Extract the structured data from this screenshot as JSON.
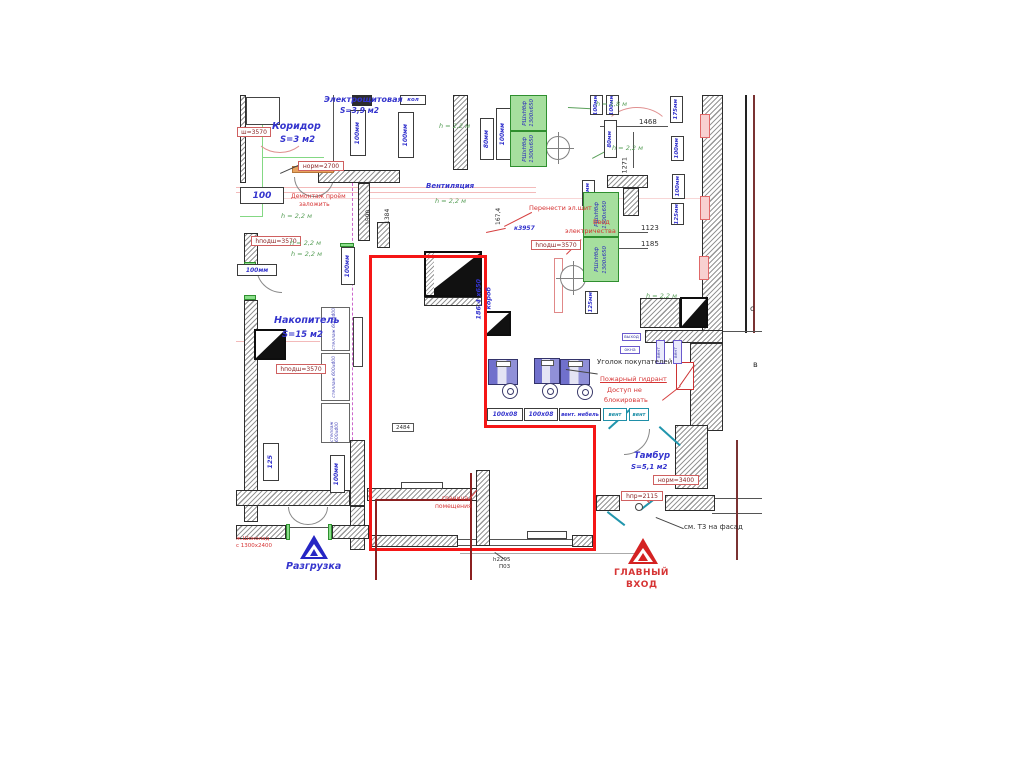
{
  "colors": {
    "premises_boundary": "#f51616",
    "handwritten_blue": "#3434cd",
    "note_red": "#d63434",
    "height_green": "#5aa05a",
    "equipment_green_fill": "#a6df9e"
  },
  "annotations": [
    {
      "n": "room-electro",
      "t": "Электрощитовая",
      "x": 88,
      "y": 1,
      "c": "blu",
      "fs": 8
    },
    {
      "n": "room-electro-area",
      "t": "S=3,9 м2",
      "x": 104,
      "y": 12,
      "c": "blu",
      "fs": 7.5
    },
    {
      "n": "room-corridor",
      "t": "Коридор",
      "x": 36,
      "y": 27,
      "c": "blu",
      "fs": 9.5
    },
    {
      "n": "room-corridor-area",
      "t": "S=3 м2",
      "x": 44,
      "y": 41,
      "c": "blu",
      "fs": 8.5
    },
    {
      "n": "vent-note",
      "t": "Вентиляция",
      "x": 190,
      "y": 88,
      "c": "blu",
      "fs": 7
    },
    {
      "n": "room-nakopitel",
      "t": "Накопитель",
      "x": 38,
      "y": 221,
      "c": "blu",
      "fs": 9.5
    },
    {
      "n": "room-nakopitel-area",
      "t": "S=15 м2",
      "x": 46,
      "y": 236,
      "c": "blu",
      "fs": 8.5
    },
    {
      "n": "room-tambur",
      "t": "Тамбур",
      "x": 398,
      "y": 357,
      "c": "blu",
      "fs": 8.5
    },
    {
      "n": "room-tambur-area",
      "t": "S=5,1 м2",
      "x": 395,
      "y": 369,
      "c": "blu",
      "fs": 7
    },
    {
      "n": "unloading-label",
      "t": "Разгрузка",
      "x": 50,
      "y": 467,
      "c": "blu",
      "fs": 9.5
    },
    {
      "n": "ref-k3957",
      "t": "к3957",
      "x": 278,
      "y": 131,
      "c": "blu",
      "fs": 6
    },
    {
      "n": "duct-size",
      "t": "186,4 х650",
      "x": 246,
      "y": 218,
      "c": "blu",
      "fs": 6.5,
      "r": -90
    },
    {
      "n": "duct-size2",
      "t": "короб",
      "x": 256,
      "y": 208,
      "c": "blu",
      "fs": 6.5,
      "r": -90
    },
    {
      "n": "note-demontazh",
      "t": "Демонтаж проём",
      "x": 55,
      "y": 99,
      "c": "red",
      "fs": 6
    },
    {
      "n": "note-demontazh2",
      "t": "заложить",
      "x": 63,
      "y": 107,
      "c": "red",
      "fs": 6
    },
    {
      "n": "note-perenesti",
      "t": "Перенести эл.щит",
      "x": 293,
      "y": 110,
      "c": "red",
      "fs": 6.5
    },
    {
      "n": "note-vvod",
      "t": "Ввод",
      "x": 357,
      "y": 124,
      "c": "red",
      "fs": 6.5
    },
    {
      "n": "note-vvod2",
      "t": "электричества",
      "x": 329,
      "y": 133,
      "c": "red",
      "fs": 6.5
    },
    {
      "n": "corner-label",
      "t": "Уголок покупателей",
      "x": 361,
      "y": 264,
      "c": "dim",
      "fs": 7
    },
    {
      "n": "hydrant-note",
      "t": "Пожарный гидрант",
      "x": 364,
      "y": 281,
      "c": "red u",
      "fs": 6.5
    },
    {
      "n": "hydrant-note2",
      "t": "Доступ не",
      "x": 371,
      "y": 292,
      "c": "red",
      "fs": 6.5
    },
    {
      "n": "hydrant-note3",
      "t": "блокировать",
      "x": 368,
      "y": 302,
      "c": "red",
      "fs": 6.5
    },
    {
      "n": "boundary-note",
      "t": "граница",
      "x": 206,
      "y": 401,
      "c": "red",
      "fs": 6
    },
    {
      "n": "boundary-note2",
      "t": "помещения",
      "x": 199,
      "y": 409,
      "c": "red",
      "fs": 6
    },
    {
      "n": "main-entrance-label",
      "t": "ГЛАВНЫЙ",
      "x": 378,
      "y": 474,
      "c": "red cap",
      "fs": 9
    },
    {
      "n": "main-entrance-label2",
      "t": "ВХОД",
      "x": 390,
      "y": 486,
      "c": "red cap",
      "fs": 9
    },
    {
      "n": "chocolate-note",
      "t": "ж.Шоколад",
      "x": 0,
      "y": 442,
      "c": "red",
      "fs": 5.5
    },
    {
      "n": "chocolate-note2",
      "t": "с 1300х2400",
      "x": 0,
      "y": 449,
      "c": "red",
      "fs": 5.5
    },
    {
      "n": "h22-1",
      "t": "h = 2,2 м",
      "x": 45,
      "y": 118,
      "c": "grn",
      "fs": 6.5
    },
    {
      "n": "h22-2",
      "t": "h = 2,2 м",
      "x": 54,
      "y": 145,
      "c": "grn",
      "fs": 6.5
    },
    {
      "n": "h22-3",
      "t": "h = 2,2 м",
      "x": 55,
      "y": 156,
      "c": "grn",
      "fs": 6.5
    },
    {
      "n": "h22-4",
      "t": "h = 2,2 м",
      "x": 203,
      "y": 28,
      "c": "grn",
      "fs": 6.5
    },
    {
      "n": "h22-5",
      "t": "h = 2,2 м",
      "x": 199,
      "y": 103,
      "c": "grn",
      "fs": 6.5
    },
    {
      "n": "h22-6",
      "t": "h = 2,2 м",
      "x": 376,
      "y": 50,
      "c": "grn",
      "fs": 6.5
    },
    {
      "n": "h22-7",
      "t": "h = 2,2 м",
      "x": 410,
      "y": 198,
      "c": "grn",
      "fs": 6.5
    },
    {
      "n": "h18",
      "t": "h = 1,8 м",
      "x": 360,
      "y": 6,
      "c": "grn",
      "fs": 6.5
    },
    {
      "n": "dim-1468",
      "t": "1468",
      "x": 403,
      "y": 24,
      "c": "dim",
      "fs": 7
    },
    {
      "n": "dim-1271",
      "t": "1271",
      "x": 392,
      "y": 72,
      "c": "dim",
      "fs": 6.5,
      "r": -90
    },
    {
      "n": "dim-1123",
      "t": "1123",
      "x": 405,
      "y": 130,
      "c": "dim",
      "fs": 7
    },
    {
      "n": "dim-1185",
      "t": "1185",
      "x": 405,
      "y": 146,
      "c": "dim",
      "fs": 7
    },
    {
      "n": "dim-167-4",
      "t": "167,4",
      "x": 266,
      "y": 124,
      "c": "dim",
      "fs": 6,
      "r": -90
    },
    {
      "n": "dim-1590",
      "t": "1590",
      "x": 136,
      "y": 124,
      "c": "dim",
      "fs": 6,
      "r": -90
    },
    {
      "n": "dim-1384",
      "t": "1384",
      "x": 155,
      "y": 123,
      "c": "dim",
      "fs": 6,
      "r": -90
    },
    {
      "n": "dim-h2295",
      "t": "h2295",
      "x": 257,
      "y": 463,
      "c": "dim",
      "fs": 5.5
    },
    {
      "n": "dim-p03",
      "t": "П03",
      "x": 263,
      "y": 470,
      "c": "dim",
      "fs": 5.5
    },
    {
      "n": "facade-note",
      "t": "см. Т3 на фасад",
      "x": 448,
      "y": 429,
      "c": "dim",
      "fs": 7
    },
    {
      "n": "letter-c",
      "t": "с",
      "x": 514,
      "y": 210,
      "c": "dim",
      "fs": 8
    },
    {
      "n": "letter-v",
      "t": "в",
      "x": 517,
      "y": 266,
      "c": "dim",
      "fs": 8
    }
  ],
  "boxes": [
    {
      "n": "pipe-100-a",
      "t": "100",
      "x": 4,
      "y": 92,
      "w": 44,
      "h": 17,
      "c": "pipe",
      "fs": 9
    },
    {
      "n": "pipe-100-b",
      "t": "100мм",
      "x": 1,
      "y": 169,
      "w": 40,
      "h": 12,
      "c": "pipe",
      "fs": 6
    },
    {
      "n": "pipe-kol",
      "t": "кол",
      "x": 164,
      "y": 0,
      "w": 26,
      "h": 10,
      "c": "pipe",
      "fs": 5.5
    },
    {
      "n": "pipe-100-1",
      "t": "100мм",
      "x": 114,
      "y": 15,
      "w": 16,
      "h": 46,
      "c": "pipev",
      "fs": 6
    },
    {
      "n": "pipe-100-2",
      "t": "100мм",
      "x": 162,
      "y": 17,
      "w": 16,
      "h": 46,
      "c": "pipev",
      "fs": 6
    },
    {
      "n": "pipe-80-1",
      "t": "80мм",
      "x": 244,
      "y": 23,
      "w": 14,
      "h": 42,
      "c": "pipev",
      "fs": 6
    },
    {
      "n": "pipe-100-3",
      "t": "100мм",
      "x": 260,
      "y": 13,
      "w": 15,
      "h": 52,
      "c": "pipev",
      "fs": 6
    },
    {
      "n": "pipe-100-4",
      "t": "100мм",
      "x": 105,
      "y": 152,
      "w": 14,
      "h": 38,
      "c": "pipev",
      "fs": 6
    },
    {
      "n": "pipe-100-5",
      "t": "100мм",
      "x": 94,
      "y": 360,
      "w": 15,
      "h": 38,
      "c": "pipev",
      "fs": 6
    },
    {
      "n": "pipe-125-1",
      "t": "125",
      "x": 27,
      "y": 348,
      "w": 16,
      "h": 38,
      "c": "pipev",
      "fs": 6.5
    },
    {
      "n": "pipe-175",
      "t": "175мм",
      "x": 434,
      "y": 1,
      "w": 13,
      "h": 27,
      "c": "pipev",
      "fs": 5.5
    },
    {
      "n": "pipe-100-6",
      "t": "100мм",
      "x": 435,
      "y": 41,
      "w": 13,
      "h": 25,
      "c": "pipev",
      "fs": 5.5
    },
    {
      "n": "pipe-100-7",
      "t": "100мм",
      "x": 436,
      "y": 79,
      "w": 13,
      "h": 25,
      "c": "pipev",
      "fs": 5.5
    },
    {
      "n": "pipe-125-2",
      "t": "125мм",
      "x": 435,
      "y": 108,
      "w": 13,
      "h": 22,
      "c": "pipev",
      "fs": 5.5
    },
    {
      "n": "pipe-100-8",
      "t": "100мм",
      "x": 346,
      "y": 85,
      "w": 13,
      "h": 26,
      "c": "pipev",
      "fs": 5.5
    },
    {
      "n": "pipe-125-3",
      "t": "125мм",
      "x": 347,
      "y": 160,
      "w": 13,
      "h": 26,
      "c": "pipev",
      "fs": 5.5
    },
    {
      "n": "pipe-125-4",
      "t": "125мм",
      "x": 349,
      "y": 196,
      "w": 13,
      "h": 23,
      "c": "pipev",
      "fs": 5.5
    },
    {
      "n": "pipe-80-2",
      "t": "80мм",
      "x": 368,
      "y": 25,
      "w": 13,
      "h": 38,
      "c": "pipev",
      "fs": 5.5
    },
    {
      "n": "pipe-100-9",
      "t": "100мм",
      "x": 354,
      "y": 0,
      "w": 13,
      "h": 20,
      "c": "pipev",
      "fs": 5.5
    },
    {
      "n": "pipe-100-10",
      "t": "100мм",
      "x": 370,
      "y": 0,
      "w": 13,
      "h": 20,
      "c": "pipev",
      "fs": 5.5
    },
    {
      "n": "pipe-100-11",
      "t": "100мм",
      "x": 287,
      "y": 0,
      "w": 13,
      "h": 18,
      "c": "pipev",
      "fs": 5.5
    },
    {
      "n": "gbox-1",
      "t": "РШхНбф",
      "l2": "1300х650",
      "x": 274,
      "y": 0,
      "w": 37,
      "h": 36,
      "c": "gbox",
      "fs": 5.5
    },
    {
      "n": "gbox-2",
      "t": "РШхНбф",
      "l2": "1300х650",
      "x": 274,
      "y": 36,
      "w": 37,
      "h": 36,
      "c": "gbox",
      "fs": 5.5
    },
    {
      "n": "gbox-3",
      "t": "РШхНбф",
      "l2": "1300х650",
      "x": 347,
      "y": 97,
      "w": 36,
      "h": 45,
      "c": "gbox",
      "fs": 5.5
    },
    {
      "n": "gbox-4",
      "t": "РШхНбф",
      "l2": "1300х650",
      "x": 347,
      "y": 142,
      "w": 36,
      "h": 45,
      "c": "gbox",
      "fs": 5.5
    },
    {
      "n": "shelf-1",
      "t": "стеллаж 600х400",
      "x": 85,
      "y": 212,
      "w": 29,
      "h": 44,
      "c": "shelf",
      "fs": 4.5
    },
    {
      "n": "shelf-2",
      "t": "стеллаж 600х400",
      "x": 85,
      "y": 258,
      "w": 29,
      "h": 48,
      "c": "shelf",
      "fs": 4.5
    },
    {
      "n": "shelf-3",
      "t": "стеллаж 600х400",
      "x": 85,
      "y": 308,
      "w": 29,
      "h": 40,
      "c": "shelf",
      "fs": 4.5
    },
    {
      "n": "lbl-sh3570",
      "t": "ш=3570",
      "x": 1,
      "y": 32,
      "w": 34,
      "h": 10,
      "c": "lbl",
      "fs": 6
    },
    {
      "n": "lbl-norm2700",
      "t": "норм=2700",
      "x": 62,
      "y": 66,
      "w": 46,
      "h": 10,
      "c": "lbl",
      "fs": 6
    },
    {
      "n": "lbl-hpodsh1",
      "t": "hподш=3570",
      "x": 15,
      "y": 141,
      "w": 50,
      "h": 10,
      "c": "lbl",
      "fs": 6
    },
    {
      "n": "lbl-hpodsh2",
      "t": "hподш=3570",
      "x": 40,
      "y": 269,
      "w": 50,
      "h": 10,
      "c": "lbl",
      "fs": 6
    },
    {
      "n": "lbl-hpodsh3",
      "t": "hподш=3570",
      "x": 295,
      "y": 145,
      "w": 50,
      "h": 10,
      "c": "lbl",
      "fs": 6
    },
    {
      "n": "lbl-norm3400",
      "t": "норм=3400",
      "x": 417,
      "y": 380,
      "w": 46,
      "h": 10,
      "c": "lbl",
      "fs": 6
    },
    {
      "n": "lbl-hpr2115",
      "t": "hпр=2115",
      "x": 385,
      "y": 396,
      "w": 42,
      "h": 10,
      "c": "lbl",
      "fs": 6
    },
    {
      "n": "lbl-2484",
      "t": "2484",
      "x": 156,
      "y": 328,
      "w": 22,
      "h": 9,
      "c": "lbl2",
      "fs": 5.5
    },
    {
      "n": "cash-1",
      "t": "100х08",
      "x": 251,
      "y": 313,
      "w": 36,
      "h": 13,
      "c": "pipe",
      "fs": 6
    },
    {
      "n": "cash-2",
      "t": "100х08",
      "x": 288,
      "y": 313,
      "w": 34,
      "h": 13,
      "c": "pipe",
      "fs": 6
    },
    {
      "n": "cash-3",
      "t": "вент. мебель",
      "x": 323,
      "y": 313,
      "w": 42,
      "h": 13,
      "c": "pipe",
      "fs": 5
    },
    {
      "n": "cash-4",
      "t": "вент",
      "x": 367,
      "y": 313,
      "w": 24,
      "h": 13,
      "c": "pipe teal",
      "fs": 5
    },
    {
      "n": "cash-5",
      "t": "вент",
      "x": 393,
      "y": 313,
      "w": 20,
      "h": 13,
      "c": "pipe teal",
      "fs": 5
    },
    {
      "n": "mic-vyhod",
      "t": "выход",
      "x": 386,
      "y": 238,
      "w": 19,
      "h": 8,
      "c": "mic",
      "fs": 4.5
    },
    {
      "n": "mic-okna",
      "t": "окна",
      "x": 384,
      "y": 251,
      "w": 20,
      "h": 8,
      "c": "mic",
      "fs": 4.5
    },
    {
      "n": "micv-1",
      "t": "вент",
      "x": 420,
      "y": 245,
      "w": 9,
      "h": 24,
      "c": "micv",
      "fs": 4.5
    },
    {
      "n": "micv-2",
      "t": "вент",
      "x": 437,
      "y": 245,
      "w": 9,
      "h": 24,
      "c": "micv",
      "fs": 4.5
    }
  ]
}
